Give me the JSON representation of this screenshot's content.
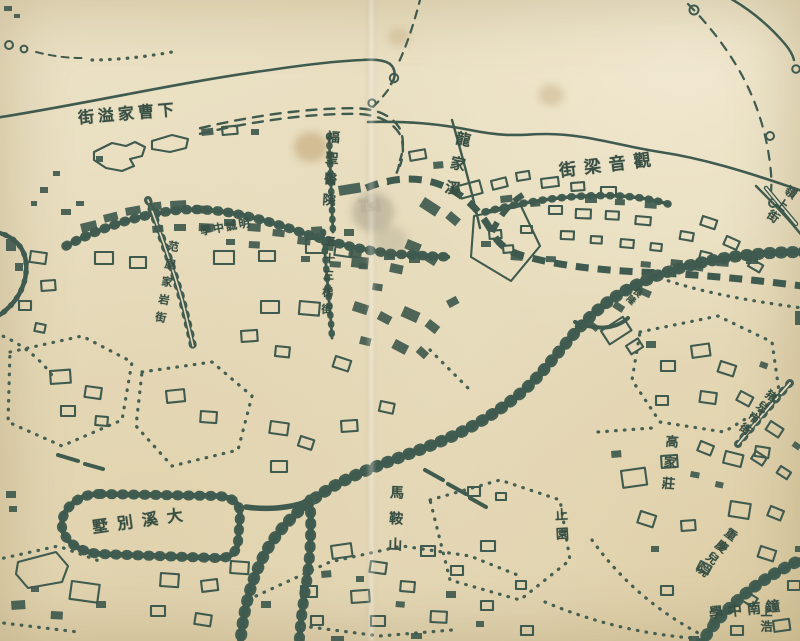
{
  "map": {
    "title": "historical-chinese-city-map",
    "ink_color": "#34534b",
    "paper_color": "#e9dfc3",
    "watermark": {
      "text": "Tsi"
    },
    "labels": [
      {
        "id": "xiacaojiayi-street",
        "text": "下曹家溢街",
        "reading_direction": "right-to-left",
        "orient": "h",
        "x": 128,
        "y": 114,
        "size": 16,
        "spacing": 4,
        "angle": -5
      },
      {
        "id": "fusheng-hospital",
        "text": "福聖醫院",
        "orient": "v",
        "x": 329,
        "y": 172,
        "size": 13,
        "spacing": 8,
        "angle": 4
      },
      {
        "id": "longjiaxi",
        "text": "龍家溪",
        "orient": "v",
        "x": 456,
        "y": 168,
        "size": 15,
        "spacing": 10,
        "angle": 12
      },
      {
        "id": "guanyinliang-street",
        "text": "觀音梁街",
        "reading_direction": "right-to-left",
        "orient": "h",
        "x": 609,
        "y": 166,
        "size": 17,
        "spacing": 8,
        "angle": -7
      },
      {
        "id": "mingcheng-school",
        "text": "明誠中學",
        "reading_direction": "right-to-left",
        "orient": "h",
        "x": 226,
        "y": 227,
        "size": 11,
        "spacing": 2,
        "angle": -10
      },
      {
        "id": "fanjiayan-street",
        "text": "范屋家岩街",
        "orient": "v",
        "x": 166,
        "y": 285,
        "size": 11,
        "spacing": 7,
        "angle": 10
      },
      {
        "id": "wushisanti-street",
        "text": "五十三梯街",
        "orient": "v",
        "x": 328,
        "y": 278,
        "size": 11,
        "spacing": 6,
        "angle": 3
      },
      {
        "id": "changlong",
        "text": "長隆",
        "orient": "v",
        "x": 633,
        "y": 295,
        "size": 9,
        "spacing": 1,
        "angle": 42
      },
      {
        "id": "zhuershi-street",
        "text": "猪兒市街",
        "orient": "v",
        "x": 757,
        "y": 413,
        "size": 11,
        "spacing": 3,
        "angle": 38
      },
      {
        "id": "lingshang-street",
        "text": "嶺上街",
        "orient": "v",
        "x": 781,
        "y": 205,
        "size": 12,
        "spacing": 3,
        "angle": 36
      },
      {
        "id": "gaojiazhuang",
        "text": "高家莊",
        "orient": "v",
        "x": 668,
        "y": 466,
        "size": 13,
        "spacing": 8,
        "angle": 5
      },
      {
        "id": "zhiyuan",
        "text": "止園",
        "orient": "v",
        "x": 560,
        "y": 527,
        "size": 13,
        "spacing": 6,
        "angle": -3
      },
      {
        "id": "chongqing-eryuan",
        "text": "重慶兒院",
        "orient": "v",
        "x": 716,
        "y": 553,
        "size": 12,
        "spacing": 3,
        "angle": 38
      },
      {
        "id": "zhongnan-school",
        "text": "鐘南中學",
        "reading_direction": "right-to-left",
        "orient": "h",
        "x": 747,
        "y": 610,
        "size": 14,
        "spacing": 5,
        "angle": -6
      },
      {
        "id": "maanshan",
        "text": "馬鞍山",
        "orient": "v",
        "x": 395,
        "y": 524,
        "size": 14,
        "spacing": 12,
        "angle": 2
      },
      {
        "id": "daxi-villa",
        "text": "大溪別墅",
        "reading_direction": "right-to-left",
        "orient": "h",
        "x": 142,
        "y": 521,
        "size": 16,
        "spacing": 9,
        "angle": -8
      },
      {
        "id": "shanghao",
        "text": "上浩",
        "orient": "v",
        "x": 766,
        "y": 620,
        "size": 12,
        "spacing": 3,
        "angle": 0
      }
    ]
  }
}
